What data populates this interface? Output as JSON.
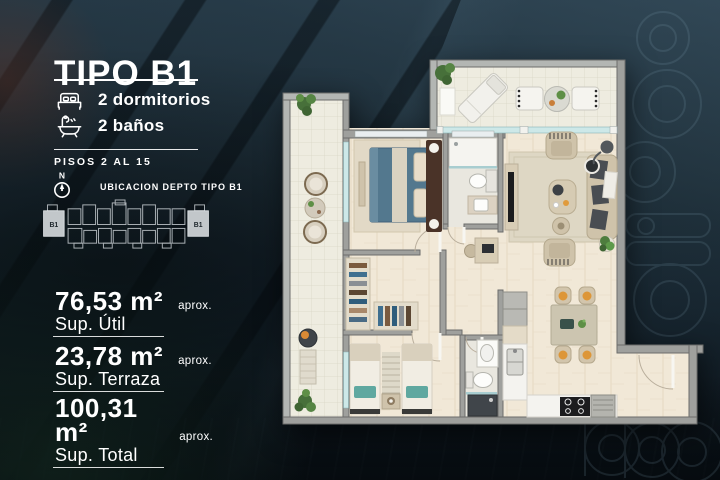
{
  "panel": {
    "title": "TIPO B1",
    "features": [
      {
        "icon": "bed-icon",
        "label": "2 dormitorios"
      },
      {
        "icon": "bath-icon",
        "label": "2 baños"
      }
    ],
    "floors_label": "PISOS 2 AL 15",
    "compass_letter": "N",
    "location_label": "UBICACION DEPTO TIPO B1",
    "unit_tag": "B1",
    "areas": [
      {
        "value": "76,53 m²",
        "approx": "aprox.",
        "label": "Sup. Útil"
      },
      {
        "value": "23,78 m²",
        "approx": "aprox.",
        "label": "Sup. Terraza"
      },
      {
        "value": "100,31 m²",
        "approx": "aprox.",
        "label": "Sup. Total"
      }
    ]
  },
  "colors": {
    "background": "#16242c",
    "text": "#ffffff",
    "plan_wall": "#9fa09d",
    "plan_wood_floor": "#f1e8d7",
    "plan_terrace_floor": "#eeece0",
    "bed_accent_blue": "#53788e",
    "teal_accent": "#5fa8a0",
    "chair_orange": "#dd9638",
    "plant_green": "#4e7d3e",
    "watermark": "#8fb3c6"
  }
}
